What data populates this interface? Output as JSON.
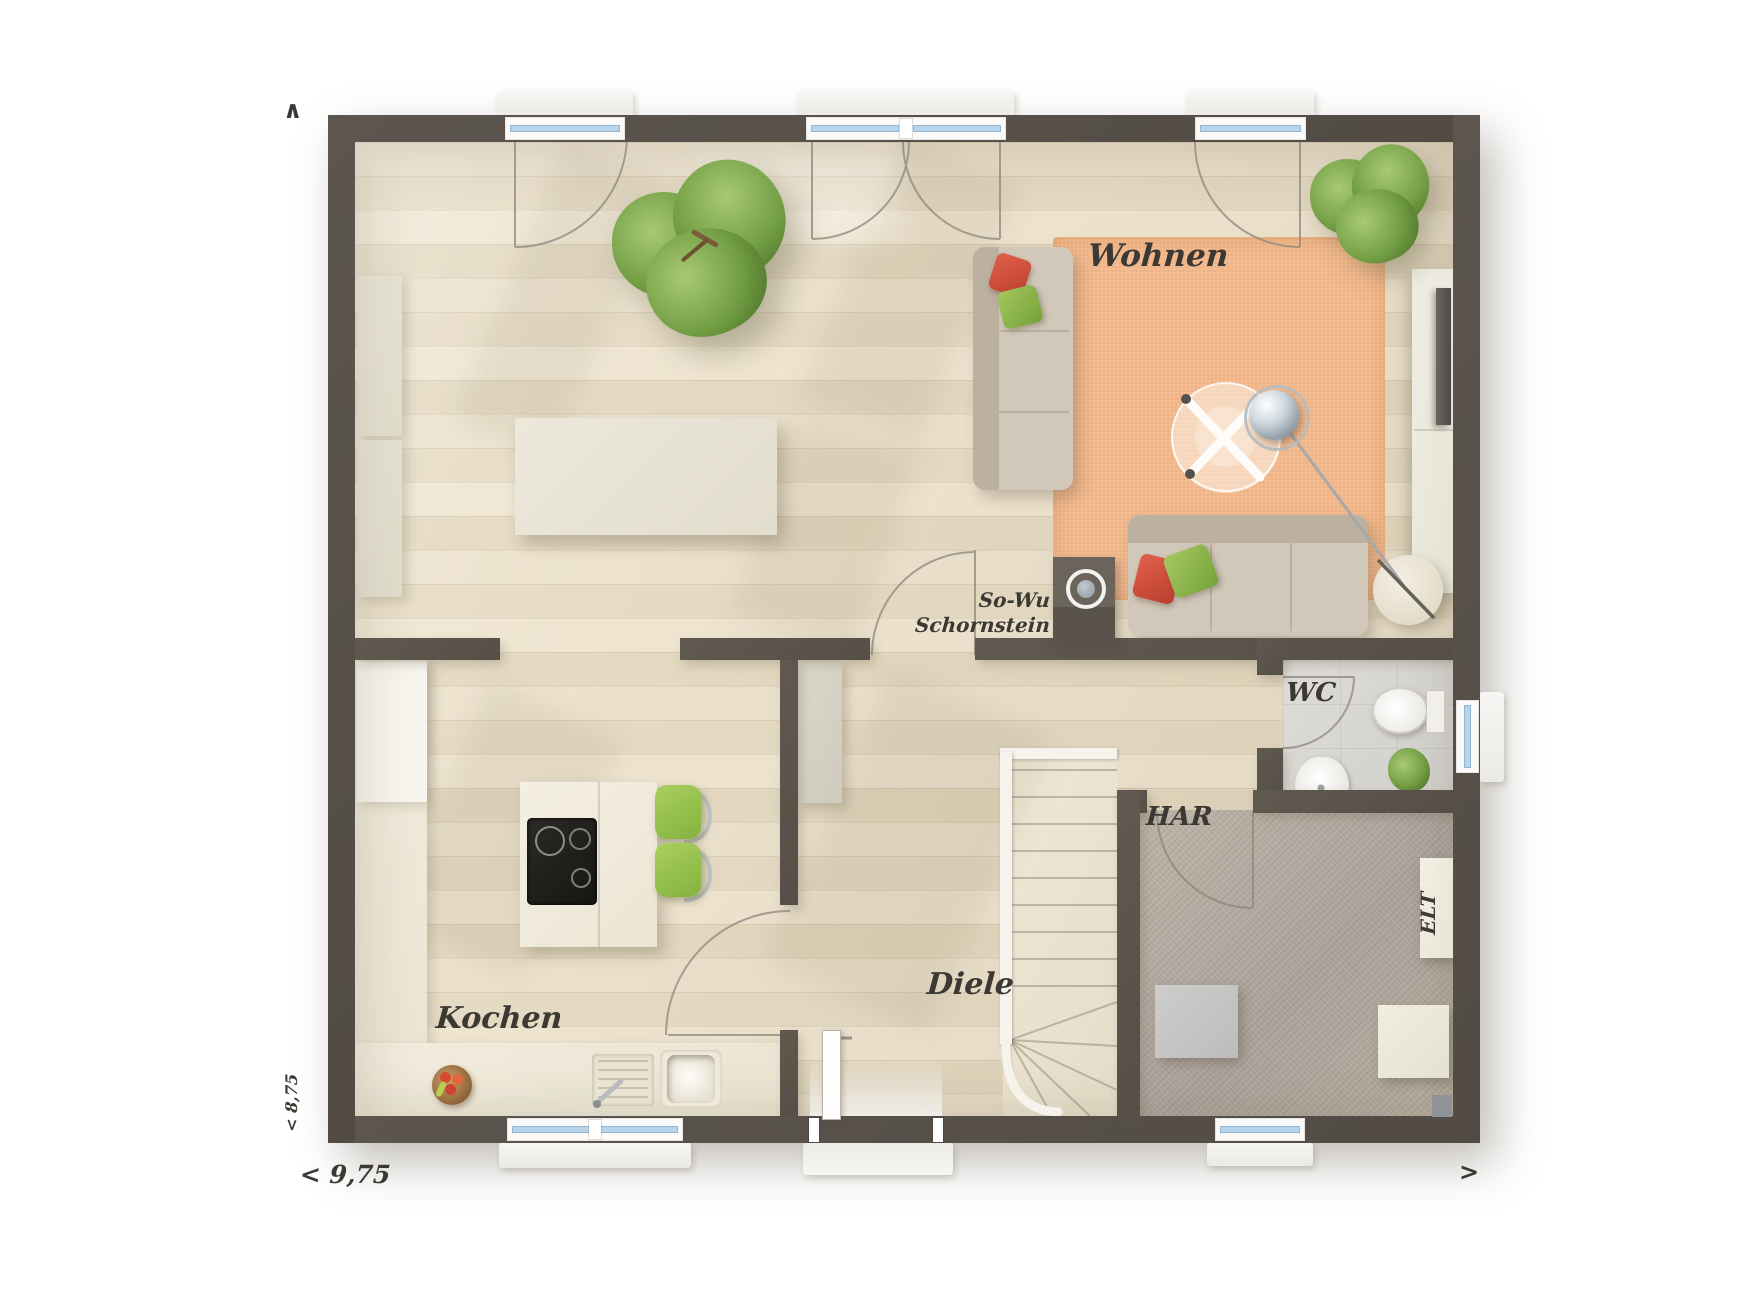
{
  "rooms": {
    "living": {
      "label": "Wohnen"
    },
    "kitchen": {
      "label": "Kochen"
    },
    "hall": {
      "label": "Diele"
    },
    "wc": {
      "label": "WC"
    },
    "utility": {
      "label": "HAR"
    },
    "electrical": {
      "label": "ELT"
    }
  },
  "annotations": {
    "chimney": {
      "line1": "So-Wu",
      "line2": "Schornstein"
    }
  },
  "dimensions": {
    "width": "< 9,75",
    "height": "< 8,75"
  },
  "markers": {
    "north": "∧",
    "east": ">"
  },
  "colors": {
    "wall": "#57514a",
    "wood_floor": "#e9dfc9",
    "rug_orange": "#f2b88c",
    "carpet_gray": "#b3aa9e",
    "tile_gray": "#d9d7d3",
    "counter_cream": "#efe9da",
    "chair_green": "#97c050",
    "pillow_red": "#d94f3d",
    "pillow_green": "#8fba4e",
    "glazing_blue": "#b8d4ea",
    "label_ink": "#3c3833"
  }
}
